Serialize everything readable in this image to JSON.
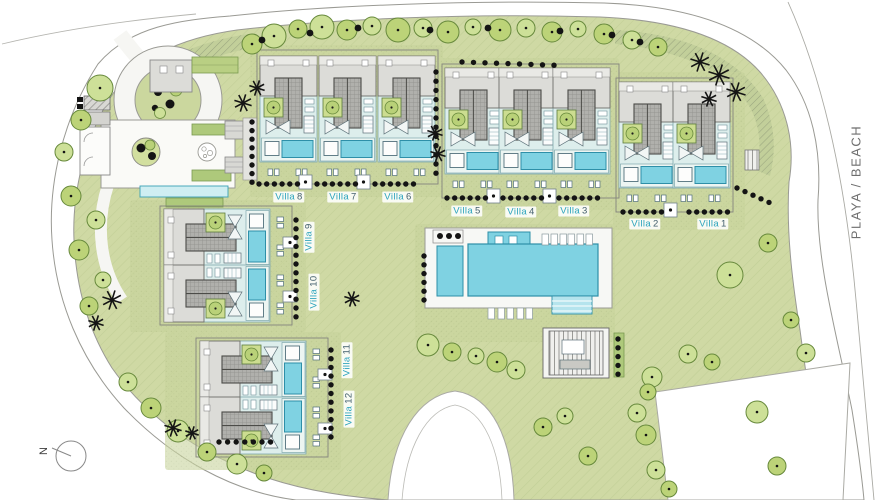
{
  "map": {
    "beach_label": "PLAYA / BEACH",
    "north_label": "N"
  },
  "villas": [
    {
      "word": "Villa",
      "num": "1"
    },
    {
      "word": "Villa",
      "num": "2"
    },
    {
      "word": "Villa",
      "num": "3"
    },
    {
      "word": "Villa",
      "num": "4"
    },
    {
      "word": "Villa",
      "num": "5"
    },
    {
      "word": "Villa",
      "num": "6"
    },
    {
      "word": "Villa",
      "num": "7"
    },
    {
      "word": "Villa",
      "num": "8"
    },
    {
      "word": "Villa",
      "num": "9"
    },
    {
      "word": "Villa",
      "num": "10"
    },
    {
      "word": "Villa",
      "num": "11"
    },
    {
      "word": "Villa",
      "num": "12"
    }
  ],
  "palette": {
    "lawn": "#cfd9a4",
    "lawn_hatch": "#c2cf97",
    "plot_grass": "#c8d49c",
    "tree_fill": "#bcd378",
    "tree_fill_alt": "#cde098",
    "tree_stroke": "#67893c",
    "foliage_dark": "#141414",
    "pool": "#7fd2e2",
    "pool_stroke": "#2e8fa8",
    "terrace": "#ddeeec",
    "pool_deck": "#ecf5f2",
    "roof_light": "#dcdcd8",
    "roof_dark": "#b0b0ac",
    "hedge_band": "#aec97b",
    "road_line": "#9a9a94",
    "label_accent": "#2ba3bd",
    "label_text": "#44606e",
    "beach_text": "#6e6e6e"
  }
}
